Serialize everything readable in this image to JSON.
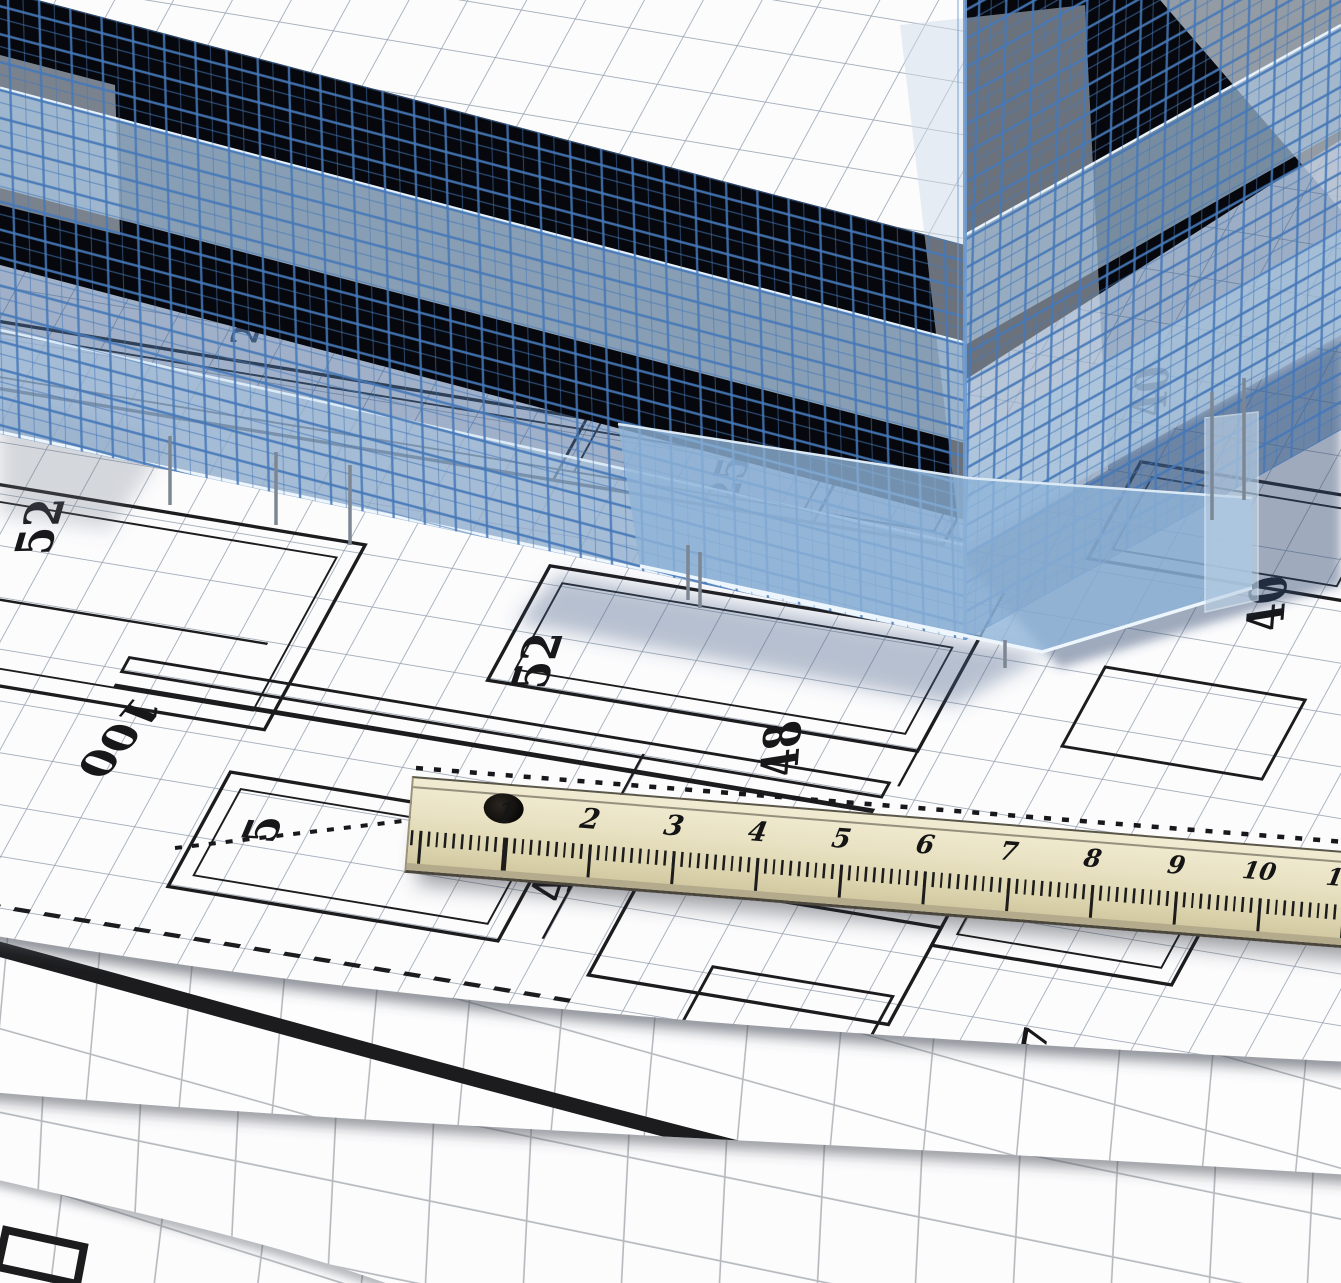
{
  "ruler": {
    "numbers": [
      "1",
      "2",
      "3",
      "4",
      "5",
      "6",
      "7",
      "8",
      "9",
      "10",
      "11"
    ]
  },
  "plan": {
    "dimension_labels": [
      {
        "text": "24"
      },
      {
        "text": "25"
      },
      {
        "text": "52"
      },
      {
        "text": "100"
      },
      {
        "text": "52"
      },
      {
        "text": "48"
      },
      {
        "text": "40"
      },
      {
        "text": "40"
      },
      {
        "text": "5"
      },
      {
        "text": "48"
      },
      {
        "text": "7"
      }
    ]
  },
  "colors": {
    "wireframe_blue": "#4578b8",
    "glass_blue": "#a9c4de",
    "deep_shadow": "#06080e",
    "paper_white": "#fcfcfd",
    "grid_gray": "#9aa6b4",
    "roll_grid_gray": "#b6babe",
    "ruler_wood": "#e6dfbf",
    "ink_black": "#1c1c1e"
  }
}
